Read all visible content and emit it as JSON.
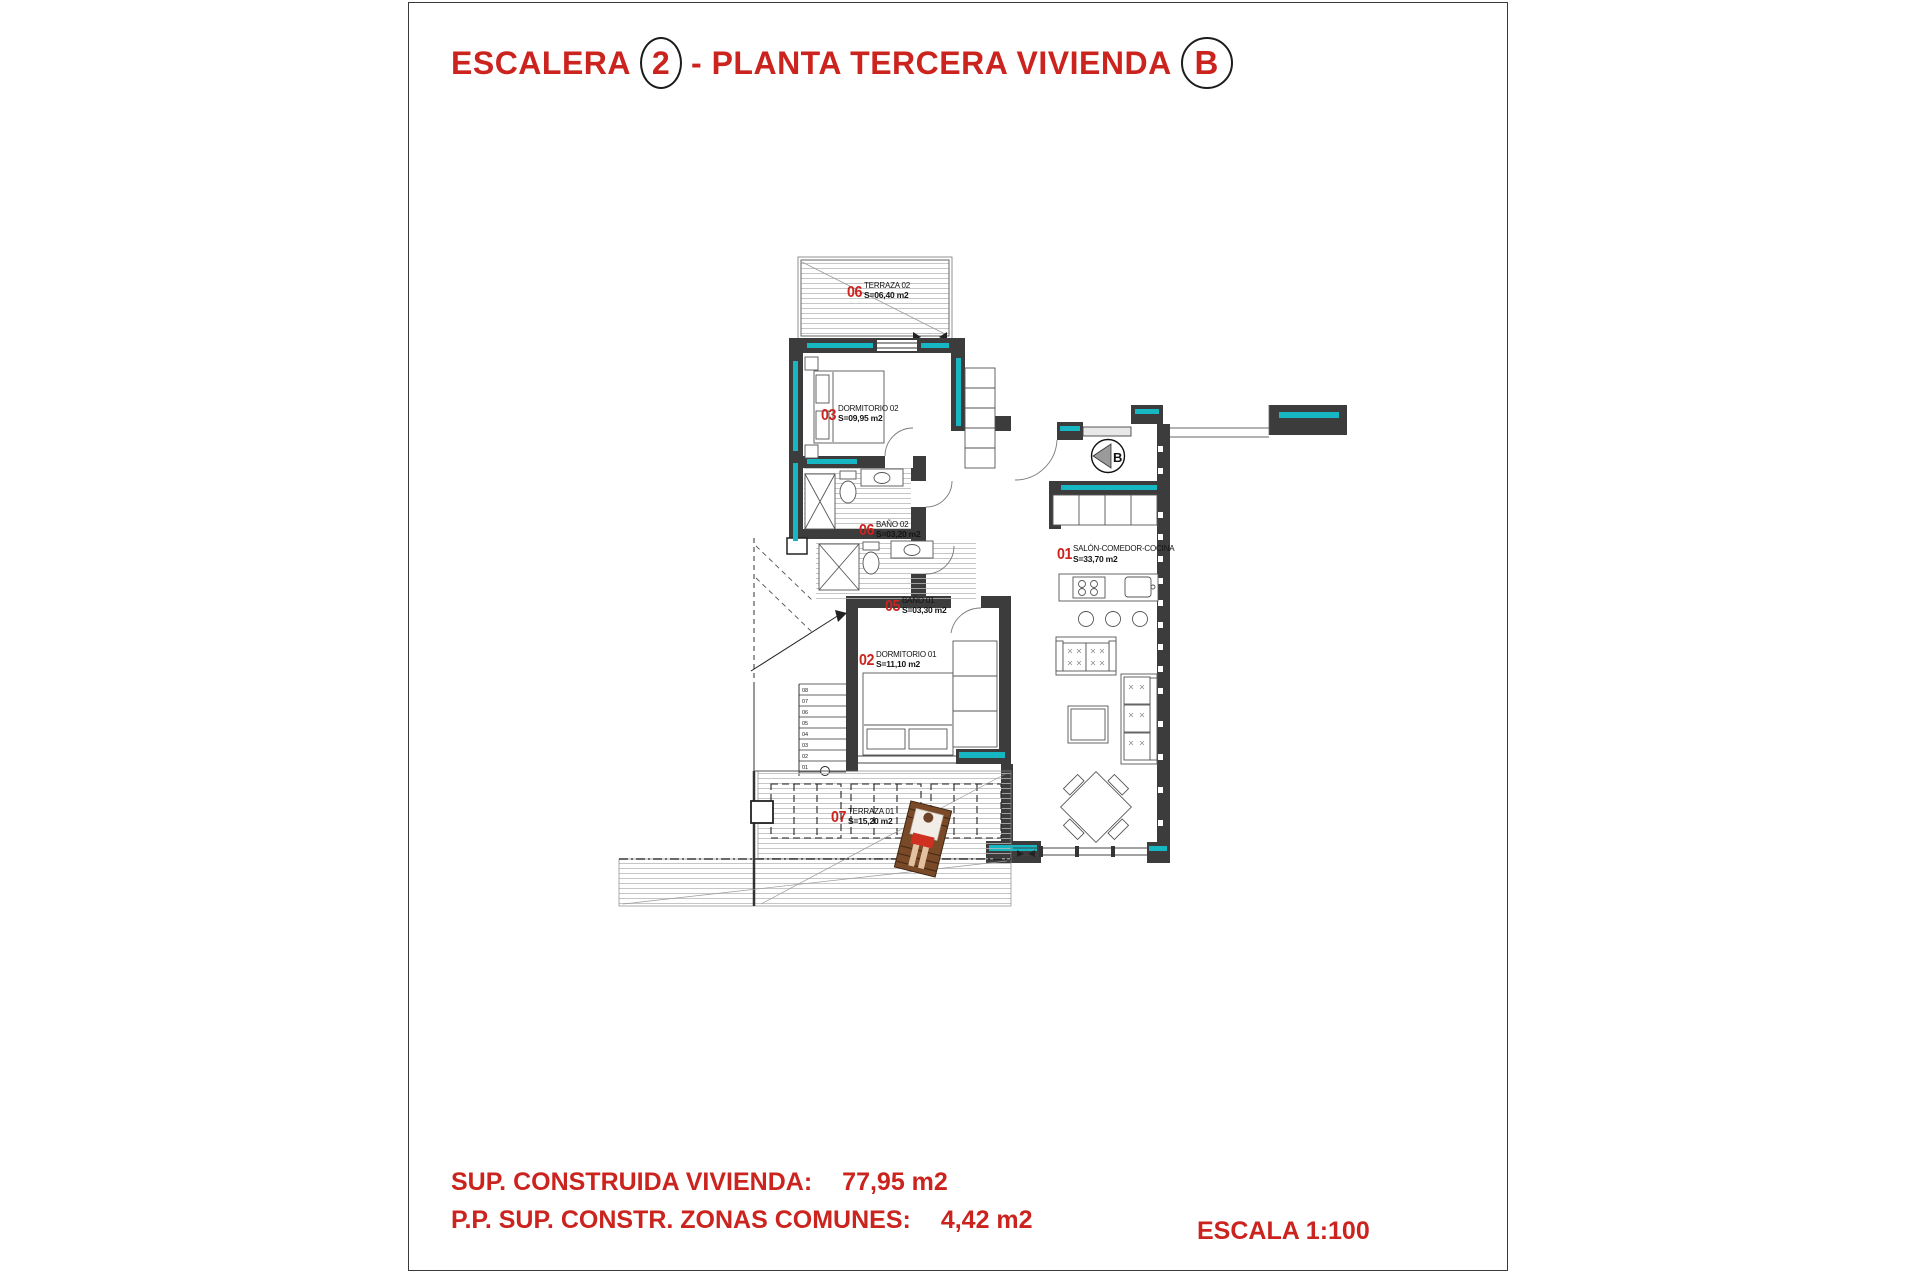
{
  "sheet": {
    "title": {
      "word1": "ESCALERA",
      "stair_number": "2",
      "word2": "- PLANTA TERCERA VIVIENDA",
      "unit_letter": "B"
    },
    "footer": {
      "built_area_label": "SUP. CONSTRUIDA VIVIENDA:",
      "built_area_value": "77,95 m2",
      "common_zones_label": "P.P. SUP. CONSTR. ZONAS COMUNES:",
      "common_zones_value": "4,42 m2",
      "scale_label": "ESCALA 1:100"
    }
  },
  "plan": {
    "entrance_marker_letter": "B",
    "rooms": [
      {
        "number": "06",
        "name": "TERRAZA 02",
        "area": "S=06,40 m2"
      },
      {
        "number": "03",
        "name": "DORMITORIO 02",
        "area": "S=09,95 m2"
      },
      {
        "number": "06",
        "name": "BAÑO 02",
        "area": "S=03,20 m2"
      },
      {
        "number": "05",
        "name": "BAÑO 01",
        "area": "S=03,30 m2"
      },
      {
        "number": "02",
        "name": "DORMITORIO 01",
        "area": "S=11,10 m2"
      },
      {
        "number": "01",
        "name": "SALÓN-COMEDOR-COCINA",
        "area": "S=33,70 m2"
      },
      {
        "number": "07",
        "name": "TERRAZA 01",
        "area": "S=15,20 m2"
      }
    ],
    "stair_step_numbers": [
      "08",
      "07",
      "06",
      "05",
      "04",
      "03",
      "02",
      "01"
    ],
    "colors": {
      "wall": "#3c3c3c",
      "insulation": "#16b6c3",
      "label_red": "#cc231e"
    }
  }
}
